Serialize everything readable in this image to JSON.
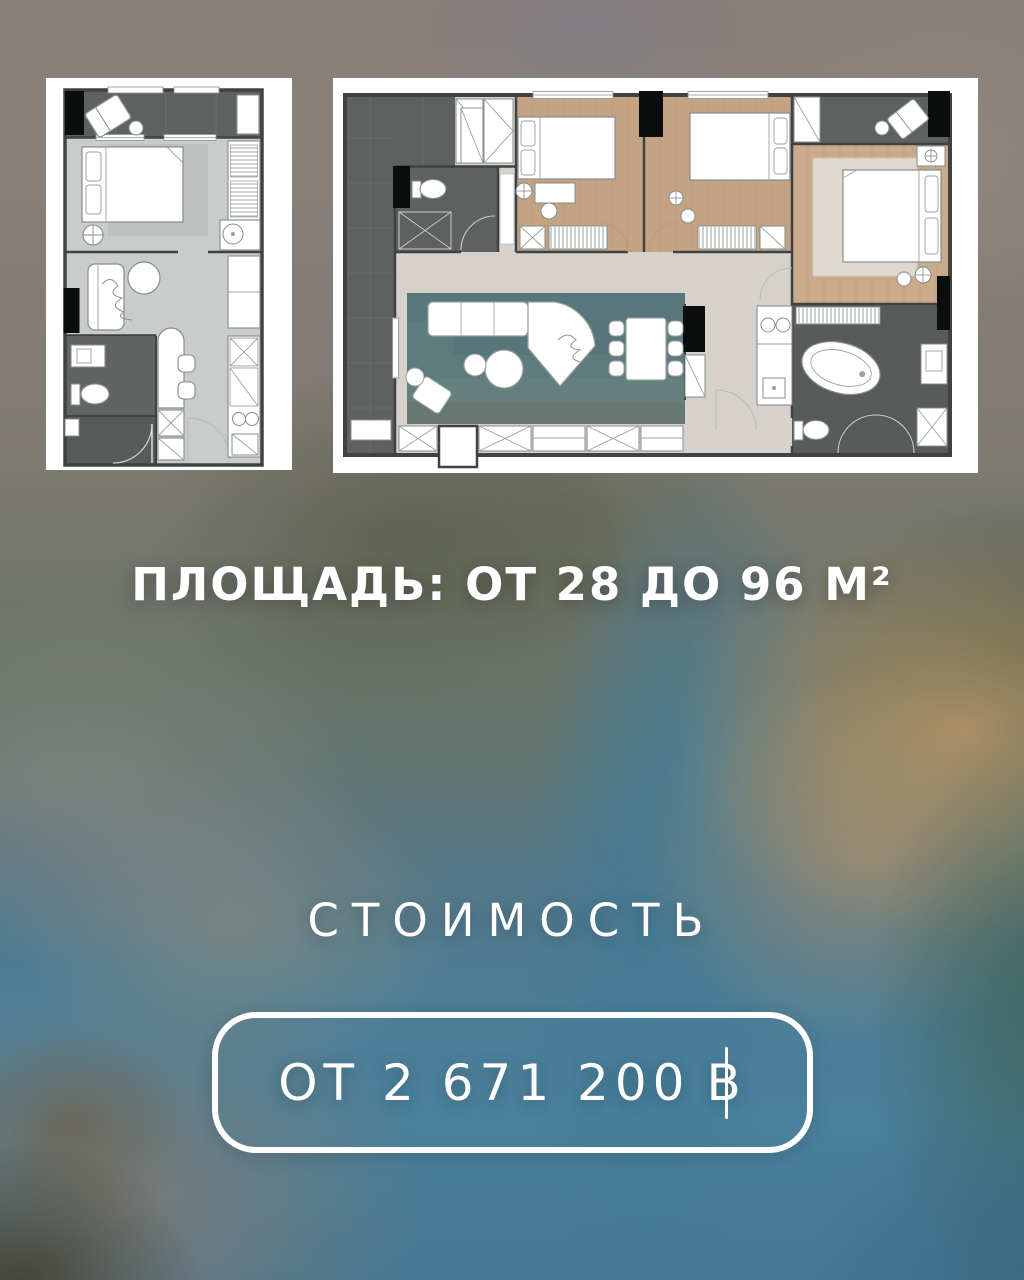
{
  "area": {
    "label": "ПЛОЩАДЬ: ОТ 28 ДО 96 М²"
  },
  "price": {
    "title": "СТОИМОСТЬ",
    "full_label": "ОТ 2 671 200 ฿",
    "text": "ОТ 2 671 200",
    "currency": "B"
  },
  "floorplans": {
    "small": {
      "name": "studio-apartment-plan"
    },
    "large": {
      "name": "three-bedroom-apartment-plan"
    }
  },
  "colors": {
    "text": "#ffffff",
    "card_bg": "#ffffff",
    "wall": "#3e4342",
    "floor_dark_gray": "#5d6260",
    "floor_light_gray": "#c9ccca",
    "floor_wood": "#c3a384",
    "floor_corridor": "#d6d2cb",
    "rug_teal": "#5e7b7d",
    "bg_top_mauve": "#8a7e79",
    "bg_olive": "#6d7257",
    "bg_teal": "#4a7f9a",
    "bg_tan": "#c49a66"
  }
}
